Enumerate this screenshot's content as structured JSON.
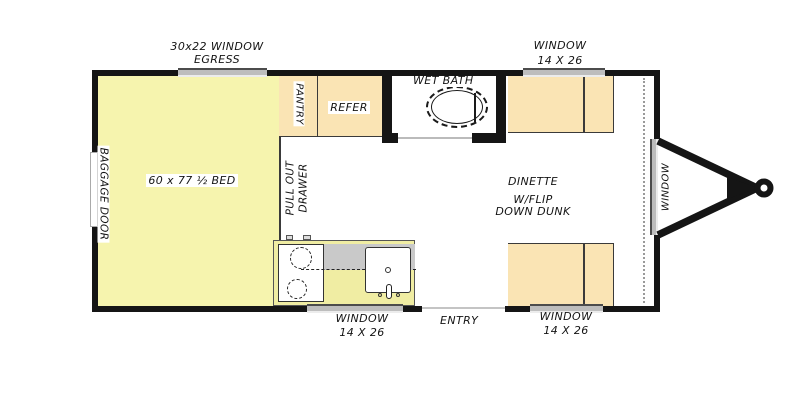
{
  "colors": {
    "wall": "#151515",
    "bed_fill": "#f6f4ae",
    "cabinet_fill": "#fae4b4",
    "counter_fill": "#f0eda3",
    "counter_gray": "#c9c9c9",
    "window_fill": "#bdbdbd",
    "line": "#3a3a3a",
    "dotted": "#9a9a9a"
  },
  "labels": {
    "egress_window_line1": "30x22 WINDOW",
    "egress_window_line2": "EGRESS",
    "window_top_right_line1": "WINDOW",
    "window_top_right_line2": "14 X 26",
    "wet_bath": "WET BATH",
    "pantry": "PANTRY",
    "refer": "REFER",
    "baggage_door": "BAGGAGE DOOR",
    "bed": "60 x 77 ½ BED",
    "pull_out_line1": "PULL OUT",
    "pull_out_line2": "DRAWER",
    "dinette_line1": "DINETTE",
    "dinette_line2": "W/FLIP",
    "dinette_line3": "DOWN DUNK",
    "window_right": "WINDOW",
    "window_bottom_left_line1": "WINDOW",
    "window_bottom_left_line2": "14 X 26",
    "entry": "ENTRY",
    "window_bottom_right_line1": "WINDOW",
    "window_bottom_right_line2": "14 X 26"
  }
}
